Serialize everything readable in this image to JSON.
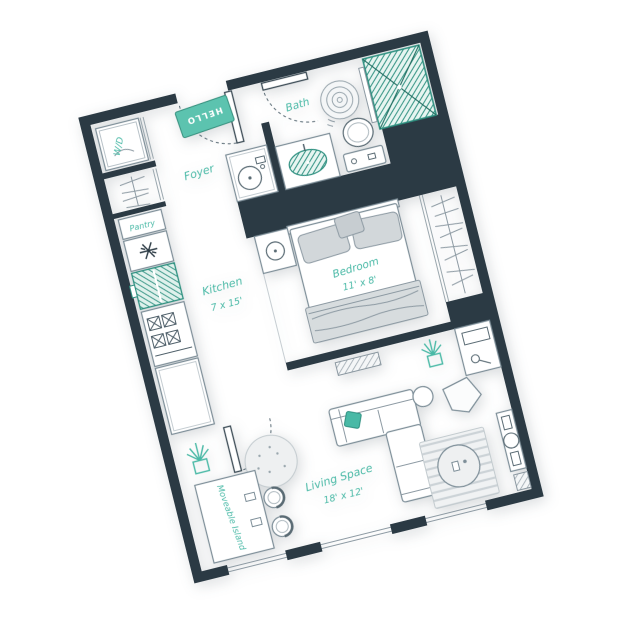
{
  "plan": {
    "rooms": {
      "foyer": {
        "label": "Foyer"
      },
      "bath": {
        "label": "Bath"
      },
      "kitchen": {
        "label": "Kitchen",
        "dims": "7 x 15'"
      },
      "bedroom": {
        "label": "Bedroom",
        "dims": "11' x 8'"
      },
      "living": {
        "label": "Living Space",
        "dims": "18' x 12'"
      },
      "pantry": {
        "label": "Pantry"
      }
    },
    "labels": {
      "wd": "W/D",
      "mat": "HELLO",
      "island": "Moveable Island"
    }
  },
  "colors": {
    "wall": "#2b3a44",
    "accent": "#49b9a6",
    "mat": "#5cc3af",
    "shower": "#2e9080",
    "outline": "#7d8e98"
  }
}
